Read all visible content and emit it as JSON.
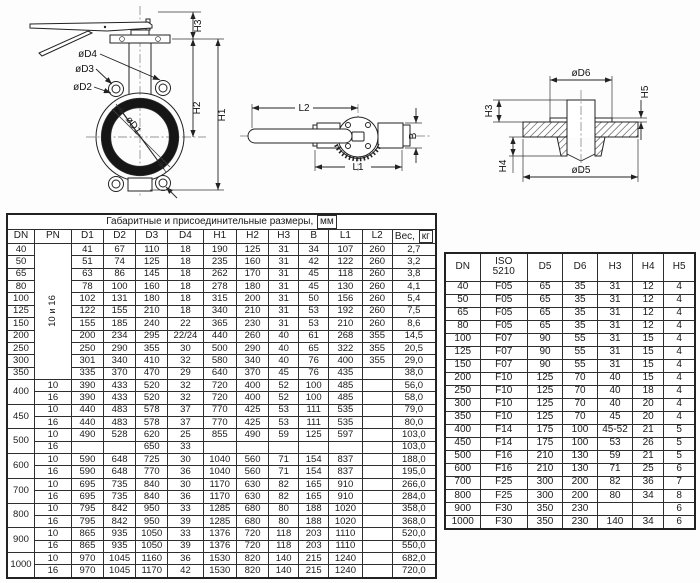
{
  "page": {
    "background": "#fdfdfd",
    "line_color": "#222222"
  },
  "drawings": {
    "front": {
      "d1": "øD1",
      "d2": "øD2",
      "d3": "øD3",
      "d4": "øD4",
      "h1": "H1",
      "h2": "H2",
      "h3": "H3"
    },
    "top": {
      "l1": "L1",
      "l2": "L2",
      "b": "B"
    },
    "section": {
      "d5": "øD5",
      "d6": "øD6",
      "h3": "H3",
      "h4": "H4",
      "h5": "H5"
    }
  },
  "main_table": {
    "title": "Габаритные и присоединительные размеры,",
    "title_unit": "мм",
    "columns": [
      "DN",
      "PN",
      "D1",
      "D2",
      "D3",
      "D4",
      "H1",
      "H2",
      "H3",
      "B",
      "L1",
      "L2"
    ],
    "weight_label": "Вес,",
    "weight_unit": "кг",
    "rows": [
      {
        "dn": "40",
        "pn": {
          "label": "10 и 16",
          "span": 11,
          "rot": true
        },
        "c": [
          "41",
          "67",
          "110",
          "18",
          "190",
          "125",
          "31",
          "34",
          "107",
          "260"
        ],
        "w": "2,7"
      },
      {
        "dn": "50",
        "c": [
          "51",
          "74",
          "125",
          "18",
          "235",
          "160",
          "31",
          "42",
          "122",
          "260"
        ],
        "w": "3,2"
      },
      {
        "dn": "65",
        "c": [
          "63",
          "86",
          "145",
          "18",
          "262",
          "170",
          "31",
          "45",
          "118",
          "260"
        ],
        "w": "3,8"
      },
      {
        "dn": "80",
        "c": [
          "78",
          "100",
          "160",
          "18",
          "278",
          "180",
          "31",
          "45",
          "130",
          "260"
        ],
        "w": "4,1"
      },
      {
        "dn": "100",
        "c": [
          "102",
          "131",
          "180",
          "18",
          "315",
          "200",
          "31",
          "50",
          "156",
          "260"
        ],
        "w": "5,4"
      },
      {
        "dn": "125",
        "c": [
          "122",
          "155",
          "210",
          "18",
          "340",
          "210",
          "31",
          "53",
          "192",
          "260"
        ],
        "w": "7,5"
      },
      {
        "dn": "150",
        "c": [
          "155",
          "185",
          "240",
          "22",
          "365",
          "230",
          "31",
          "53",
          "210",
          "260"
        ],
        "w": "8,6"
      },
      {
        "dn": "200",
        "c": [
          "200",
          "234",
          "295",
          "22/24",
          "440",
          "260",
          "40",
          "61",
          "268",
          "355"
        ],
        "w": "14,5"
      },
      {
        "dn": "250",
        "c": [
          "250",
          "290",
          "355",
          "30",
          "500",
          "290",
          "40",
          "65",
          "322",
          "355"
        ],
        "w": "20,5"
      },
      {
        "dn": "300",
        "c": [
          "301",
          "340",
          "410",
          "32",
          "580",
          "340",
          "40",
          "76",
          "400",
          "355"
        ],
        "w": "29,0"
      },
      {
        "dn": "350",
        "c": [
          "335",
          "370",
          "470",
          "29",
          "640",
          "370",
          "45",
          "76",
          "435",
          ""
        ],
        "w": "38,0"
      },
      {
        "dn": {
          "label": "400",
          "span": 2
        },
        "pn": "10",
        "c": [
          "390",
          "433",
          "520",
          "32",
          "720",
          "400",
          "52",
          "100",
          "485",
          ""
        ],
        "w": "56,0"
      },
      {
        "pn": "16",
        "c": [
          "390",
          "433",
          "520",
          "32",
          "720",
          "400",
          "52",
          "100",
          "485",
          ""
        ],
        "w": "58,0"
      },
      {
        "dn": {
          "label": "450",
          "span": 2
        },
        "pn": "10",
        "c": [
          "440",
          "483",
          "578",
          "37",
          "770",
          "425",
          "53",
          "111",
          "535",
          ""
        ],
        "w": "79,0"
      },
      {
        "pn": "16",
        "c": [
          "440",
          "483",
          "578",
          "37",
          "770",
          "425",
          "53",
          "111",
          "535",
          ""
        ],
        "w": "80,0"
      },
      {
        "dn": {
          "label": "500",
          "span": 2
        },
        "pn": "10",
        "c": [
          "490",
          "528",
          "620",
          "25",
          "855",
          "490",
          "59",
          "125",
          "597",
          ""
        ],
        "w": "103,0"
      },
      {
        "pn": "16",
        "c": [
          "",
          "",
          "650",
          "33",
          "",
          "",
          "",
          "",
          "",
          ""
        ],
        "w": "103,0"
      },
      {
        "dn": {
          "label": "600",
          "span": 2
        },
        "pn": "10",
        "c": [
          "590",
          "648",
          "725",
          "30",
          "1040",
          "560",
          "71",
          "154",
          "837",
          ""
        ],
        "w": "188,0"
      },
      {
        "pn": "16",
        "c": [
          "590",
          "648",
          "770",
          "36",
          "1040",
          "560",
          "71",
          "154",
          "837",
          ""
        ],
        "w": "195,0"
      },
      {
        "dn": {
          "label": "700",
          "span": 2
        },
        "pn": "10",
        "c": [
          "695",
          "735",
          "840",
          "30",
          "1170",
          "630",
          "82",
          "165",
          "910",
          ""
        ],
        "w": "266,0"
      },
      {
        "pn": "16",
        "c": [
          "695",
          "735",
          "840",
          "36",
          "1170",
          "630",
          "82",
          "165",
          "910",
          ""
        ],
        "w": "284,0"
      },
      {
        "dn": {
          "label": "800",
          "span": 2
        },
        "pn": "10",
        "c": [
          "795",
          "842",
          "950",
          "33",
          "1285",
          "680",
          "80",
          "188",
          "1020",
          ""
        ],
        "w": "358,0"
      },
      {
        "pn": "16",
        "c": [
          "795",
          "842",
          "950",
          "39",
          "1285",
          "680",
          "80",
          "188",
          "1020",
          ""
        ],
        "w": "368,0"
      },
      {
        "dn": {
          "label": "900",
          "span": 2
        },
        "pn": "10",
        "c": [
          "865",
          "935",
          "1050",
          "33",
          "1376",
          "720",
          "118",
          "203",
          "1110",
          ""
        ],
        "w": "520,0"
      },
      {
        "pn": "16",
        "c": [
          "865",
          "935",
          "1050",
          "39",
          "1376",
          "720",
          "118",
          "203",
          "1110",
          ""
        ],
        "w": "550,0"
      },
      {
        "dn": {
          "label": "1000",
          "span": 2
        },
        "pn": "10",
        "c": [
          "970",
          "1045",
          "1160",
          "36",
          "1530",
          "820",
          "140",
          "215",
          "1240",
          ""
        ],
        "w": "682,0"
      },
      {
        "pn": "16",
        "c": [
          "970",
          "1045",
          "1170",
          "42",
          "1530",
          "820",
          "140",
          "215",
          "1240",
          ""
        ],
        "w": "720,0"
      }
    ]
  },
  "iso_table": {
    "columns": [
      "DN",
      "ISO\n5210",
      "D5",
      "D6",
      "H3",
      "H4",
      "H5"
    ],
    "rows": [
      [
        "40",
        "F05",
        "65",
        "35",
        "31",
        "12",
        "4"
      ],
      [
        "50",
        "F05",
        "65",
        "35",
        "31",
        "12",
        "4"
      ],
      [
        "65",
        "F05",
        "65",
        "35",
        "31",
        "12",
        "4"
      ],
      [
        "80",
        "F05",
        "65",
        "35",
        "31",
        "12",
        "4"
      ],
      [
        "100",
        "F07",
        "90",
        "55",
        "31",
        "15",
        "4"
      ],
      [
        "125",
        "F07",
        "90",
        "55",
        "31",
        "15",
        "4"
      ],
      [
        "150",
        "F07",
        "90",
        "55",
        "31",
        "15",
        "4"
      ],
      [
        "200",
        "F10",
        "125",
        "70",
        "40",
        "15",
        "4"
      ],
      [
        "250",
        "F10",
        "125",
        "70",
        "40",
        "18",
        "4"
      ],
      [
        "300",
        "F10",
        "125",
        "70",
        "40",
        "20",
        "4"
      ],
      [
        "350",
        "F10",
        "125",
        "70",
        "45",
        "20",
        "4"
      ],
      [
        "400",
        "F14",
        "175",
        "100",
        "45-52",
        "21",
        "5"
      ],
      [
        "450",
        "F14",
        "175",
        "100",
        "53",
        "26",
        "5"
      ],
      [
        "500",
        "F16",
        "210",
        "130",
        "59",
        "21",
        "5"
      ],
      [
        "600",
        "F16",
        "210",
        "130",
        "71",
        "25",
        "6"
      ],
      [
        "700",
        "F25",
        "300",
        "200",
        "82",
        "36",
        "7"
      ],
      [
        "800",
        "F25",
        "300",
        "200",
        "80",
        "34",
        "8"
      ],
      [
        "900",
        "F30",
        "350",
        "230",
        "",
        "",
        "6"
      ],
      [
        "1000",
        "F30",
        "350",
        "230",
        "140",
        "34",
        "6"
      ]
    ]
  }
}
